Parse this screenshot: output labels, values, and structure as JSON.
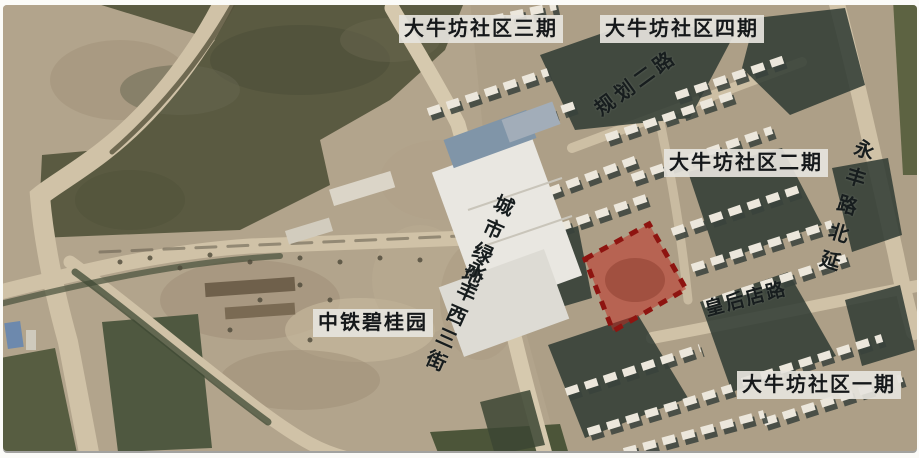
{
  "window": {
    "width": 919,
    "height": 458,
    "kind": "annotated satellite map photo"
  },
  "map": {
    "labels": {
      "community_phase3": "大牛坊社区三期",
      "community_phase4": "大牛坊社区四期",
      "community_phase2": "大牛坊社区二期",
      "community_phase1": "大牛坊社区一期",
      "planned_road_2": "规划二路",
      "yongfeng_road_north_ext": "永丰路北延",
      "urban_green_space": "城市绿地",
      "yongfeng_west_3rd_street": "永丰西三街",
      "china_railway_country_garden": "中铁碧桂园",
      "huanghoudian_road": "皇后店路"
    },
    "parcel_highlight": {
      "fill": "#c1271e",
      "fill_opacity": "0.5",
      "stroke": "#8e1410",
      "style": "dashed-square-border"
    },
    "colors": {
      "dirt_base": "#b2a48c",
      "field_green": "#5a5a41",
      "tree_green": "#2e3a32",
      "road": "#d0c2a7",
      "rooftop_white": "#ece7dc",
      "building_shadow": "#39423c",
      "label_box_bg": "#e6e4dd",
      "label_text": "#15181a"
    }
  }
}
